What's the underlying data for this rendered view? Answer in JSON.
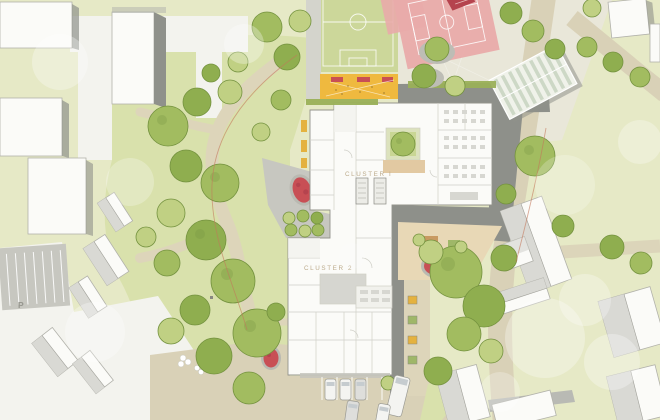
{
  "site_plan": {
    "type": "architectural-site-plan",
    "labels": {
      "cluster_1": "CLUSTER I",
      "cluster_2": "CLUSTER 2",
      "parking": "P"
    },
    "palette": {
      "grass_base": "#e6e9c6",
      "grass_park": "#d9e1ac",
      "grass_field": "#ccd79a",
      "concrete_pale": "#e9e7d9",
      "road_white": "#f3f3ee",
      "road_sand": "#d9d1b7",
      "path_sand": "#ddd5ba",
      "asphalt_light": "#c7c7c0",
      "paving_dark": "#8e908a",
      "plaza_gray": "#c7c7c0",
      "building_white": "#fbfbf8",
      "wall_gray": "#94948c",
      "room_line": "#cfcfc7",
      "roof_gray": "#d9d9d4",
      "roof_dark": "#8f918b",
      "court_pink": "#e9abaa",
      "red_equipment": "#c84f55",
      "red_structure": "#b5434e",
      "play_orange": "#efb93f",
      "terrace_tan": "#e8d8b6",
      "patio_tan": "#e2c9a2",
      "tree_green_1": "#a2bc60",
      "tree_green_2": "#8fae4f",
      "tree_green_3": "#c0d083",
      "tree_dark": "#74923f",
      "hedge_green": "#9ab059",
      "car_white": "#f4f4f1",
      "car_gray": "#dededb",
      "window_gray": "#c6cccf",
      "greenhouse_stripe": "#cdd8c6",
      "boundary_red": "#c3765a"
    }
  }
}
